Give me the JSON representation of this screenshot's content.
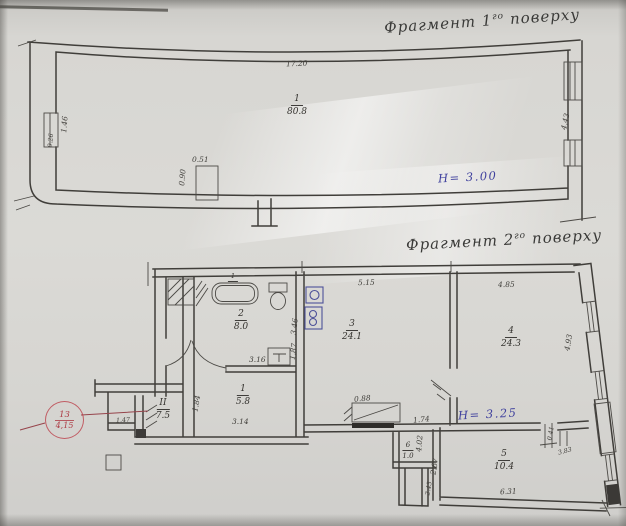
{
  "titles": {
    "floor1": {
      "prefix": "Фрагмент",
      "number": "1",
      "ordinal": "го",
      "suffix": "поверху"
    },
    "floor2": {
      "prefix": "Фрагмент",
      "number": "2",
      "ordinal": "го",
      "suffix": "поверху"
    }
  },
  "floor1": {
    "room1": {
      "num": "1",
      "area": "80.8"
    },
    "height_note": "Н= 3.00",
    "dims": {
      "width_top": "17.20",
      "window_left_height": "1.46",
      "window_left_depth": "0.26",
      "column_width": "0.51",
      "column_depth": "0.90",
      "window_right_height": "4.43"
    }
  },
  "floor2": {
    "height_note": "Н= 3.25",
    "rooms": {
      "bathroom": {
        "num": "2",
        "area": "8.0"
      },
      "living": {
        "num": "3",
        "area": "24.1"
      },
      "bedroom": {
        "num": "4",
        "area": "24.3"
      },
      "hall": {
        "num": "1",
        "area": "5.8"
      },
      "stair": {
        "num": "II",
        "area": "7.5"
      },
      "closet": {
        "num": "6",
        "area": "1.0"
      },
      "kitchen": {
        "num": "5",
        "area": "10.4"
      }
    },
    "fixtures": {
      "bathtub_label": "1"
    },
    "dims": {
      "top_left": "5.15",
      "top_right": "4.85",
      "bath_wall_upper": "3.46",
      "bath_wall_lower": "1.87",
      "sink_offset": "3.16",
      "hall_width": "3.14",
      "hall_wall": "1.84",
      "stove_width": "0.88",
      "stove_offset": "1.74",
      "window_right_height": "4.93",
      "kitchen_width": "6.31",
      "kitchen_depth": "2.67",
      "closet_wall": "4.02",
      "door_jamb": "0.41",
      "door_offset": "3.83",
      "porch_width": "1.47",
      "flue_depth": "2.43"
    },
    "stamp": {
      "top": "13",
      "bottom": "4,15"
    }
  }
}
